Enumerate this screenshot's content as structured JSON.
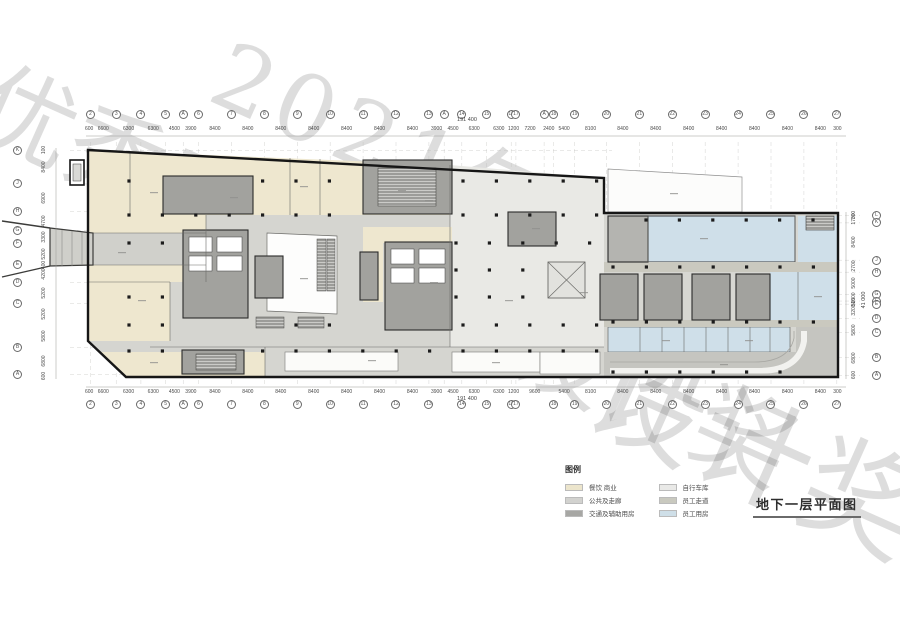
{
  "watermark": {
    "line1": "优秀工程勘察设计奖",
    "line2": "2021年北京市",
    "line3": "设计奖"
  },
  "title": "地下一层平面图",
  "legend": {
    "heading": "图例",
    "items": [
      {
        "label": "餐饮 商业",
        "color": "#ece5cc"
      },
      {
        "label": "公共及走廊",
        "color": "#d2d2cf"
      },
      {
        "label": "交通及辅助用房",
        "color": "#a7a7a4"
      },
      {
        "label": "自行车库",
        "color": "#e9e9e7"
      },
      {
        "label": "员工走道",
        "color": "#c9c9bf"
      },
      {
        "label": "员工用房",
        "color": "#cfdfe8"
      }
    ]
  },
  "grid": {
    "total": "191 400",
    "right_total": "41 000",
    "top": {
      "dims": [
        600,
        6600,
        6300,
        6300,
        4500,
        3900,
        8400,
        8400,
        8400,
        8400,
        8400,
        8400,
        8400,
        3900,
        4500,
        6300,
        6300,
        1200,
        7200,
        2400,
        5400,
        8100,
        8400,
        8400,
        8400,
        8400,
        8400,
        8400,
        8400,
        300
      ],
      "bubbles": [
        {
          "label": "2",
          "mm": 600
        },
        {
          "label": "3",
          "mm": 7200
        },
        {
          "label": "4",
          "mm": 13500
        },
        {
          "label": "5",
          "mm": 19800
        },
        {
          "label": "A",
          "mm": 24300
        },
        {
          "label": "6",
          "mm": 28200
        },
        {
          "label": "7",
          "mm": 36600
        },
        {
          "label": "8",
          "mm": 45000
        },
        {
          "label": "9",
          "mm": 53400
        },
        {
          "label": "10",
          "mm": 61800
        },
        {
          "label": "11",
          "mm": 70200
        },
        {
          "label": "12",
          "mm": 78600
        },
        {
          "label": "13",
          "mm": 87000
        },
        {
          "label": "A",
          "mm": 90900
        },
        {
          "label": "14",
          "mm": 95400
        },
        {
          "label": "15",
          "mm": 101700
        },
        {
          "label": "16",
          "mm": 108000
        },
        {
          "label": "17",
          "mm": 109200
        },
        {
          "label": "A",
          "mm": 116400
        },
        {
          "label": "18",
          "mm": 118800
        },
        {
          "label": "19",
          "mm": 124200
        },
        {
          "label": "20",
          "mm": 132300
        },
        {
          "label": "21",
          "mm": 140700
        },
        {
          "label": "22",
          "mm": 149100
        },
        {
          "label": "23",
          "mm": 157500
        },
        {
          "label": "24",
          "mm": 165900
        },
        {
          "label": "25",
          "mm": 174300
        },
        {
          "label": "26",
          "mm": 182700
        },
        {
          "label": "27",
          "mm": 191100
        }
      ]
    },
    "bottom": {
      "dims": [
        600,
        6600,
        6300,
        6300,
        4500,
        3900,
        8400,
        8400,
        8400,
        8400,
        8400,
        8400,
        8400,
        3900,
        4500,
        6300,
        6300,
        1200,
        9600,
        5400,
        8100,
        8400,
        8400,
        8400,
        8400,
        8400,
        8400,
        8400,
        300
      ],
      "bubbles": [
        {
          "label": "2",
          "mm": 600
        },
        {
          "label": "3",
          "mm": 7200
        },
        {
          "label": "4",
          "mm": 13500
        },
        {
          "label": "5",
          "mm": 19800
        },
        {
          "label": "A",
          "mm": 24300
        },
        {
          "label": "6",
          "mm": 28200
        },
        {
          "label": "7",
          "mm": 36600
        },
        {
          "label": "8",
          "mm": 45000
        },
        {
          "label": "9",
          "mm": 53400
        },
        {
          "label": "10",
          "mm": 61800
        },
        {
          "label": "11",
          "mm": 70200
        },
        {
          "label": "12",
          "mm": 78600
        },
        {
          "label": "13",
          "mm": 87000
        },
        {
          "label": "14",
          "mm": 95400
        },
        {
          "label": "15",
          "mm": 101700
        },
        {
          "label": "16",
          "mm": 108000
        },
        {
          "label": "17",
          "mm": 109200
        },
        {
          "label": "18",
          "mm": 118800
        },
        {
          "label": "19",
          "mm": 124200
        },
        {
          "label": "20",
          "mm": 132300
        },
        {
          "label": "21",
          "mm": 140700
        },
        {
          "label": "22",
          "mm": 149100
        },
        {
          "label": "23",
          "mm": 157500
        },
        {
          "label": "24",
          "mm": 165900
        },
        {
          "label": "25",
          "mm": 174300
        },
        {
          "label": "26",
          "mm": 182700
        },
        {
          "label": "27",
          "mm": 191100
        }
      ]
    },
    "left": {
      "dims": [
        100,
        8400,
        6900,
        4700,
        3300,
        5200,
        400,
        4200,
        5200,
        5200,
        5800,
        6800,
        600
      ],
      "bubbles": [
        {
          "label": "K",
          "mm": 100
        },
        {
          "label": "J",
          "mm": 8500
        },
        {
          "label": "H",
          "mm": 15400
        },
        {
          "label": "G",
          "mm": 20100
        },
        {
          "label": "F",
          "mm": 23400
        },
        {
          "label": "E",
          "mm": 28600
        },
        {
          "label": "D",
          "mm": 33200
        },
        {
          "label": "C",
          "mm": 38400
        },
        {
          "label": "B",
          "mm": 49400
        },
        {
          "label": "A",
          "mm": 56200
        }
      ]
    },
    "right": {
      "dims": [
        300,
        1700,
        8400,
        2700,
        5000,
        1500,
        500,
        3200,
        5800,
        6800,
        600
      ],
      "bubbles": [
        {
          "label": "L",
          "mm": 300
        },
        {
          "label": "K",
          "mm": 2000
        },
        {
          "label": "J",
          "mm": 10400
        },
        {
          "label": "H",
          "mm": 13100
        },
        {
          "label": "G",
          "mm": 18100
        },
        {
          "label": "F",
          "mm": 19600
        },
        {
          "label": "E",
          "mm": 20300
        },
        {
          "label": "D",
          "mm": 23500
        },
        {
          "label": "C",
          "mm": 26700
        },
        {
          "label": "B",
          "mm": 32300
        },
        {
          "label": "A",
          "mm": 36400
        }
      ]
    }
  }
}
